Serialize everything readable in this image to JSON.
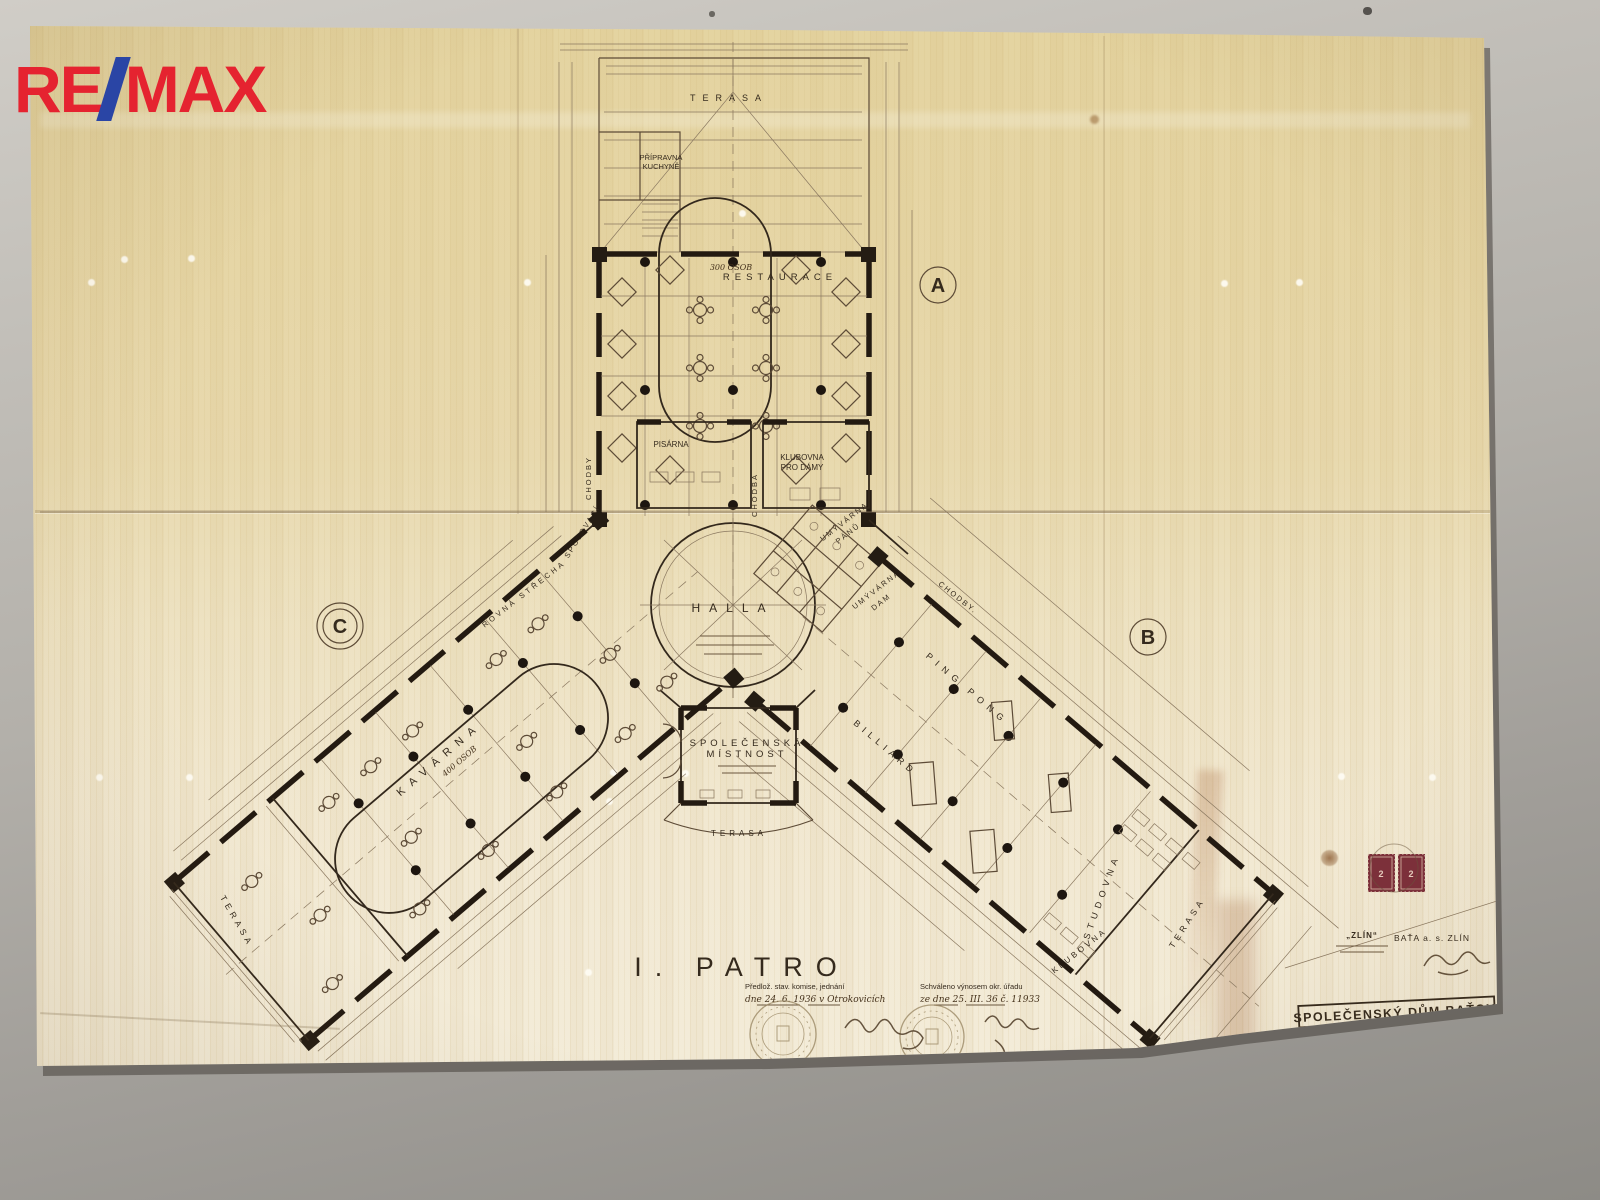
{
  "colors": {
    "remax_red": "#e52330",
    "remax_blue": "#2a45a5",
    "stamp_red": "#7c2f3a",
    "ink": "#3f3325",
    "paper": "#eee4c6"
  },
  "watermark": {
    "re": "RE",
    "max": "MAX"
  },
  "plan": {
    "floor_title": "I. PATRO",
    "wing_a": "A",
    "wing_b": "B",
    "wing_c": "C",
    "rooms": {
      "terasa_top": "TERASA",
      "pripravna_1": "PŘÍPRAVNA",
      "pripravna_2": "KUCHYNĚ",
      "restaurace": "RESTAURACE",
      "restaurace_cap": "300 OSOB",
      "pisarna": "PISÁRNA",
      "klubovna_1": "KLUBOVNA",
      "klubovna_2": "PRO DÁMY",
      "chodba": "CHODBA",
      "chodby_l": "CHODBY",
      "chodby_r": "CHODBY.",
      "halla": "HALLA",
      "umyv_p1": "UMÝVÁRNA",
      "umyv_p2": "PÁNŮ",
      "umyv_d1": "UMÝVÁRNA",
      "umyv_d2": "DAM",
      "spojovaci": "SPOJOVACÍ",
      "rovna_strecha": "ROVNÁ STŘECHA",
      "kavarna": "KAVÁRNA",
      "kavarna_cap": "400 OSOB",
      "terasa_c": "TERASA",
      "ping_pong": "PING PONG",
      "billiard": "BILLIARD",
      "spolecenska_1": "SPOLEČENSKÁ",
      "spolecenska_2": "MÍSTNOST",
      "terasa_mid": "TERASA",
      "studovna": "STUDOVNA",
      "terasa_b": "TERASA",
      "klubovna_b": "KLUBOVNA"
    }
  },
  "approval": {
    "left_1": "Předlož. stav. komise, jednání",
    "left_2": "dne 24. 6. 1936 v Otrokovicích",
    "right_1": "Schváleno výnosem okr. úřadu",
    "right_2": "ze dne 25. III. 36 č. 11933"
  },
  "company": {
    "zlin": "„ZLÍN“",
    "bata": "BAŤA a. s. ZLÍN"
  },
  "stamps": {
    "value": "2"
  },
  "title_block": {
    "title": "SPOLEČENSKÝ DŮM BAŤOV.",
    "scale_label": "Měřítko",
    "scale_value": "1:100",
    "drawing_no": "B66, 3"
  }
}
